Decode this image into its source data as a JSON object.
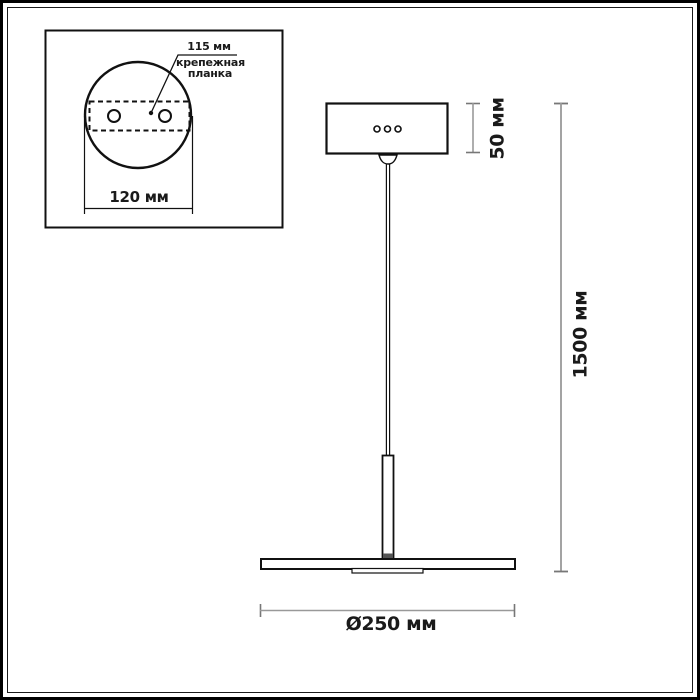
{
  "diagram": {
    "type": "pendant-lamp-technical-drawing",
    "inset": {
      "hole_spacing_label": "115 мм",
      "mount_plate_label_line1": "крепежная",
      "mount_plate_label_line2": "планка",
      "canopy_diameter_label": "120 мм"
    },
    "main": {
      "canopy_height_label": "50 мм",
      "suspension_length_label": "1500 мм",
      "shade_diameter_label": "Ø250 мм",
      "canopy_dot_count": 3
    },
    "colors": {
      "background": "#ffffff",
      "drawing_line": "#111111",
      "dimension_line": "#999999",
      "dimension_cap": "#777777",
      "text": "#1a1a1a"
    }
  }
}
